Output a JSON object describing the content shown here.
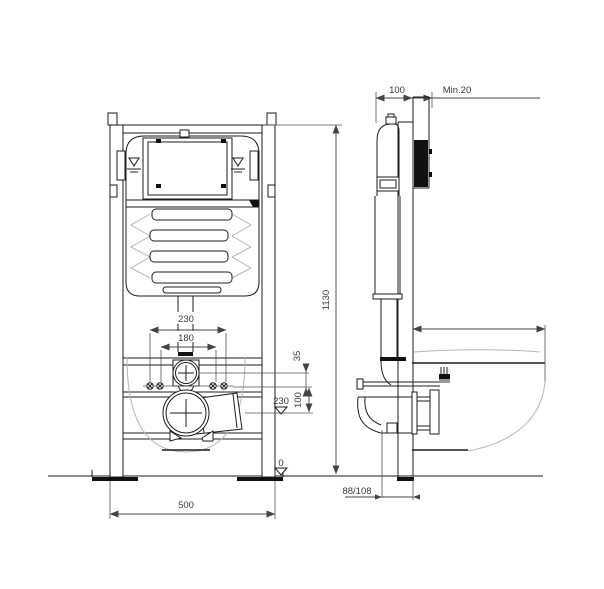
{
  "drawing": {
    "front_view": {
      "dim_230": "230",
      "dim_180": "180",
      "dim_35": "35",
      "dim_100": "100",
      "datum_230": "230",
      "datum_0": "0",
      "dim_1130": "1130",
      "dim_500": "500"
    },
    "side_view": {
      "dim_100": "100",
      "dim_min20": "Min.20",
      "dim_88_108": "88/108"
    },
    "colors": {
      "line": "#1d1d1d",
      "light_outline": "#b5b5b5",
      "dimension_text": "#3a3a3a"
    }
  }
}
